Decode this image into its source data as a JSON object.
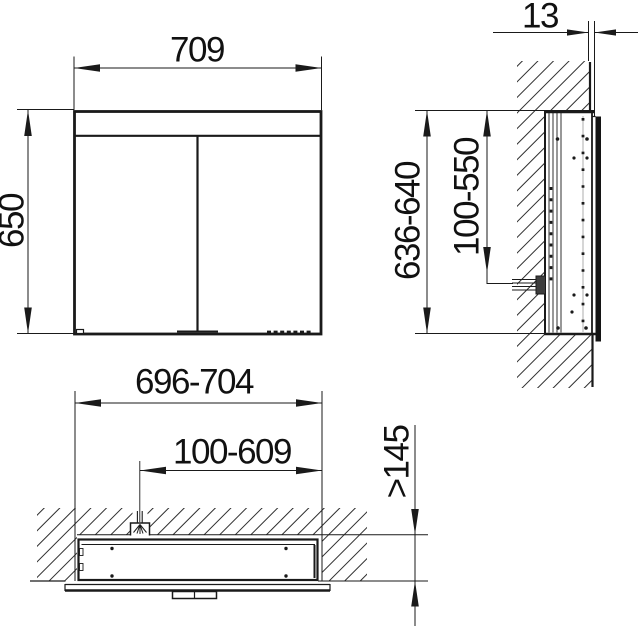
{
  "front_view": {
    "width_mm": "709",
    "height_mm": "650"
  },
  "side_view": {
    "protrusion_mm": "13",
    "height_range_mm": "636-640",
    "connection_height_range_mm": "100-550"
  },
  "plan_view": {
    "recess_width_mm": "696-704",
    "connection_range_mm": "100-609",
    "recess_depth_mm": ">145"
  },
  "colors": {
    "line": "#1a1a1a",
    "background": "#ffffff",
    "hatch": "#2e2e2e"
  }
}
